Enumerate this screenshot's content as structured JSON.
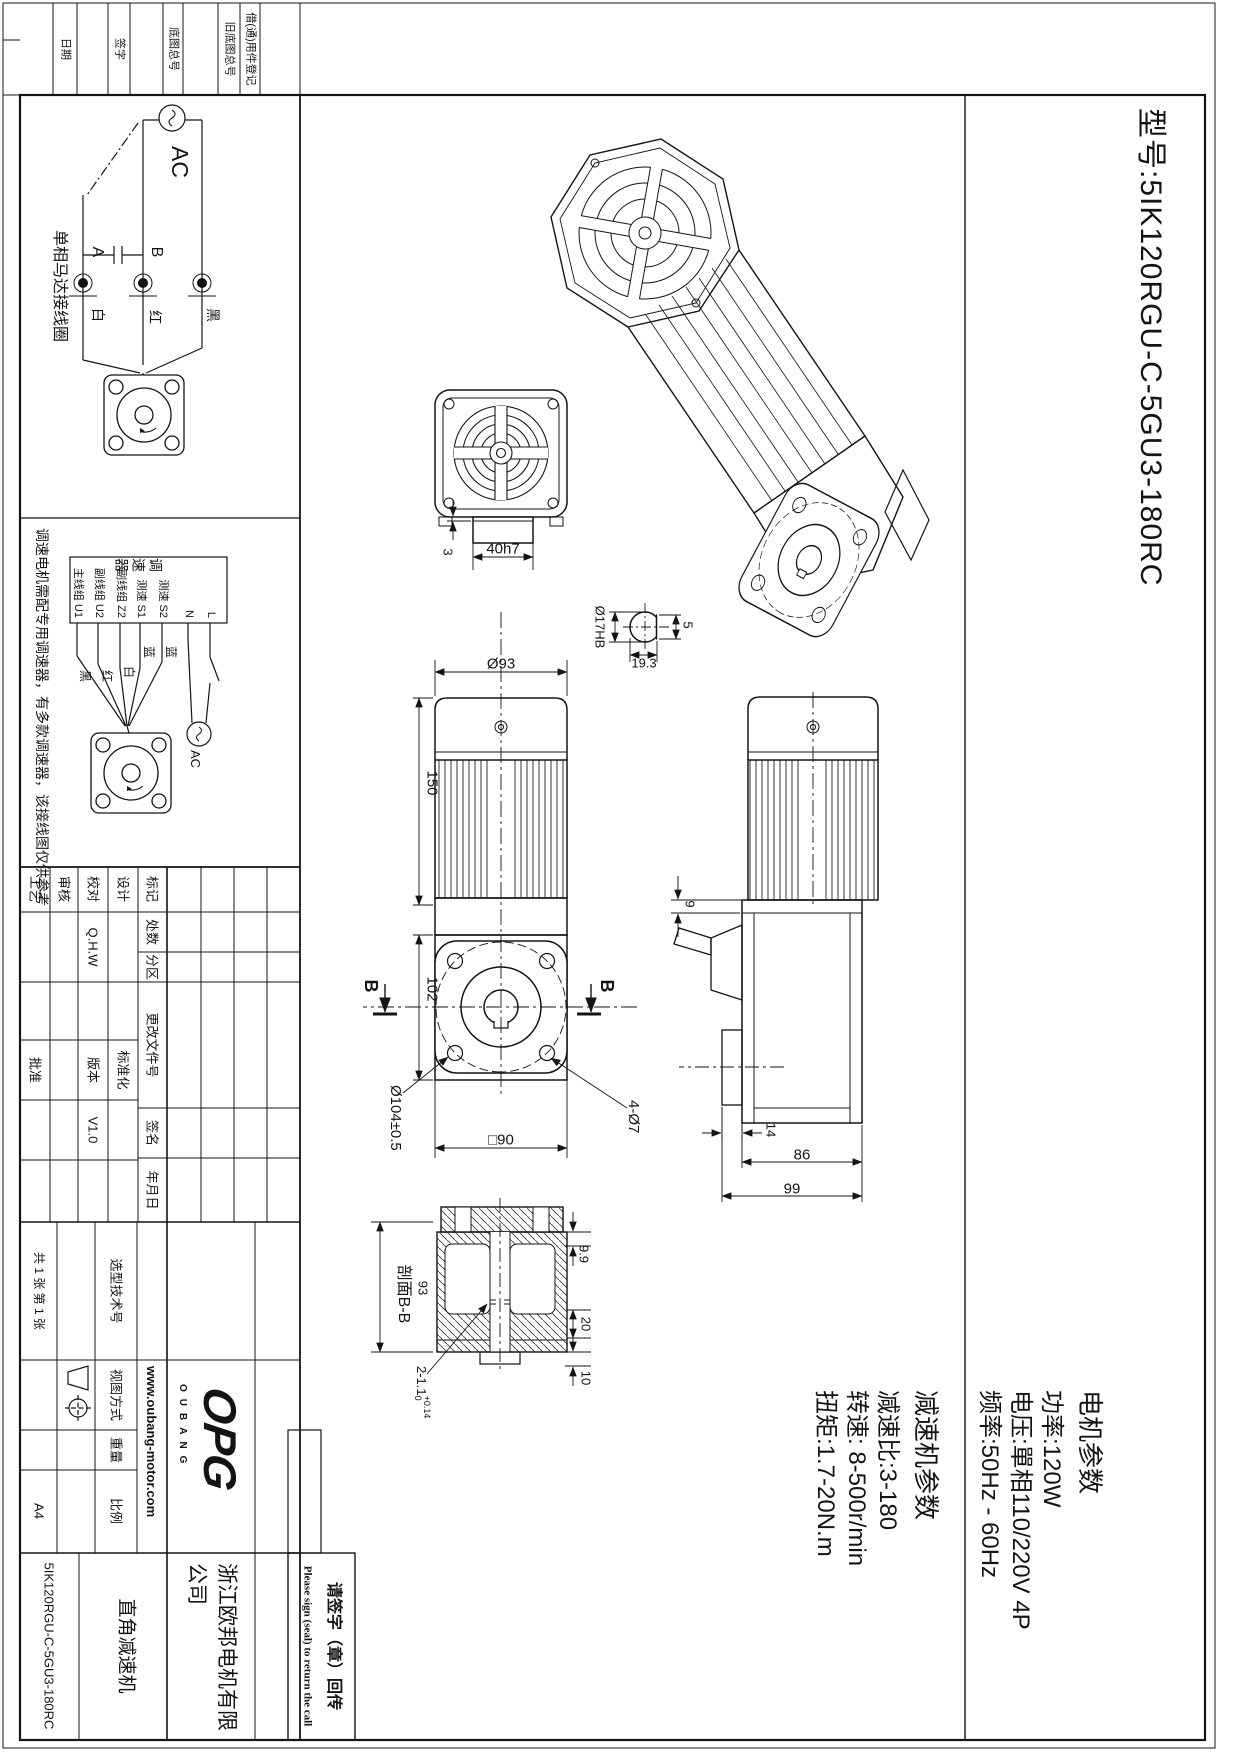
{
  "model_header": {
    "title": "型号:5IK120RGU-C-5GU3-180RC"
  },
  "motor_params": {
    "heading": "电机参数",
    "lines": [
      "功率:120W",
      "电压:單相110/220V 4P",
      "频率:50Hz - 60Hz"
    ]
  },
  "reducer_params": {
    "heading": "减速机参数",
    "lines": [
      "减速比:3-180",
      "转速: 8-500r/min",
      "扭矩:1.7-20N.m"
    ]
  },
  "edge_strip": {
    "items": [
      "借(通)用件登记",
      "旧底图总号",
      "底图总号",
      "签字",
      "日期"
    ]
  },
  "wiring_single": {
    "caption": "单相马达接线圈",
    "ac": "AC",
    "term_a": "A",
    "term_b": "B",
    "white": "白",
    "red": "红",
    "black": "黑"
  },
  "wiring_ctrl": {
    "caption": "调速电机需配专用调速器，有多款调速器，该接线图仅供参考",
    "box": "调速器",
    "terms": [
      "L",
      "N",
      "测速 S2",
      "测速 S1",
      "副线组 Z2",
      "副线组 U2",
      "主线组 U1"
    ],
    "colors": [
      "蓝",
      "蓝",
      "白",
      "红",
      "黑"
    ],
    "ac": "AC"
  },
  "dims": {
    "d40": "40h7",
    "d3": "3",
    "d17": "Ø17HB",
    "d193": "19.3",
    "d5": "5",
    "d93": "Ø93",
    "d150": "150",
    "d102": "102",
    "d104": "Ø104±0.5",
    "d90": "□90",
    "d47": "4-Ø7",
    "d9": "9",
    "d14": "14",
    "d86": "86",
    "d99": "99",
    "sec": "剖面B-B",
    "s93": "93",
    "d99b": "9.9",
    "d20": "20",
    "d10": "10",
    "groove": "2-1.1",
    "tolu": "+0.14",
    "told": "0",
    "b": "B"
  },
  "title_block": {
    "rev": [
      "标记",
      "处数",
      "分区",
      "更改文件号",
      "签名",
      "年月日"
    ],
    "design": "设计",
    "check": "校对",
    "audit": "审核",
    "process": "工艺",
    "approve": "批准",
    "designer": "Q.H.W",
    "std": "标准化",
    "ver_label": "版本",
    "version": "V1.0",
    "sel_no": "选型技术号",
    "view": "视图方式",
    "weight": "重量",
    "scale": "比例",
    "sheets": "共 1 张 第 1 张",
    "paper": "A4",
    "logo": "OPG",
    "logo_sub": "OUBANG",
    "site": "www.oubang-motor.com",
    "company1": "浙江欧邦电机有限",
    "company2": "公司",
    "product": "直角减速机",
    "number": "5IK120RGU-C-5GU3-180RC",
    "sign_cn": "请签字（章）回传",
    "sign_en": "Please sign (seal) to return the call"
  }
}
